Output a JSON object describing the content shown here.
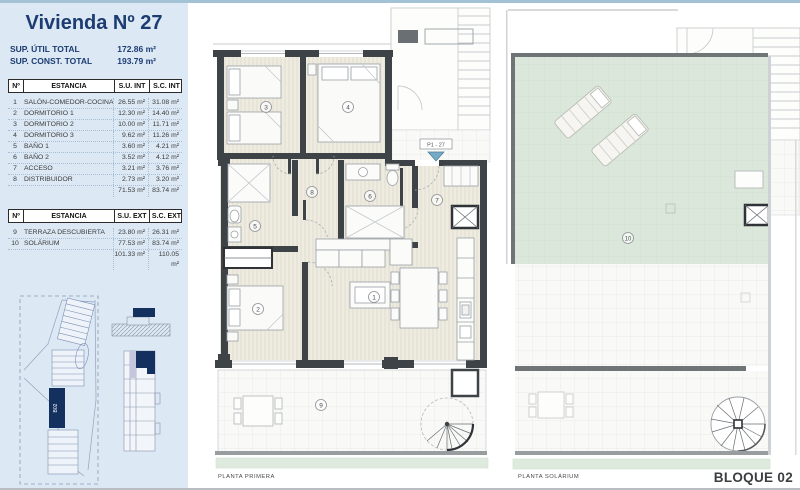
{
  "header": {
    "title": "Vivienda Nº 27"
  },
  "summary": {
    "rows": [
      {
        "label": "SUP. ÚTIL TOTAL",
        "value": "172.86 m²"
      },
      {
        "label": "SUP. CONST. TOTAL",
        "value": "193.79 m²"
      }
    ]
  },
  "interior_table": {
    "headers": {
      "num": "Nº",
      "name": "ESTANCIA",
      "su": "S.U. INT",
      "sc": "S.C. INT"
    },
    "rows": [
      {
        "num": "1",
        "name": "SALÓN-COMEDOR-COCINA",
        "su": "26.55 m²",
        "sc": "31.08 m²"
      },
      {
        "num": "2",
        "name": "DORMITORIO 1",
        "su": "12.30 m²",
        "sc": "14.40 m²"
      },
      {
        "num": "3",
        "name": "DORMITORIO 2",
        "su": "10.00 m²",
        "sc": "11.71 m²"
      },
      {
        "num": "4",
        "name": "DORMITORIO 3",
        "su": "9.62 m²",
        "sc": "11.26 m²"
      },
      {
        "num": "5",
        "name": "BAÑO 1",
        "su": "3.60 m²",
        "sc": "4.21 m²"
      },
      {
        "num": "6",
        "name": "BAÑO 2",
        "su": "3.52 m²",
        "sc": "4.12 m²"
      },
      {
        "num": "7",
        "name": "ACCESO",
        "su": "3.21 m²",
        "sc": "3.76 m²"
      },
      {
        "num": "8",
        "name": "DISTRIBUIDOR",
        "su": "2.73 m²",
        "sc": "3.20 m²"
      }
    ],
    "total": {
      "su": "71.53 m²",
      "sc": "83.74 m²"
    }
  },
  "exterior_table": {
    "headers": {
      "num": "Nº",
      "name": "ESTANCIA",
      "su": "S.U. EXT",
      "sc": "S.C. EXT"
    },
    "rows": [
      {
        "num": "9",
        "name": "TERRAZA DESCUBIERTA",
        "su": "23.80 m²",
        "sc": "26.31 m²"
      },
      {
        "num": "10",
        "name": "SOLÁRIUM",
        "su": "77.53 m²",
        "sc": "83.74 m²"
      }
    ],
    "total": {
      "su": "101.33 m²",
      "sc": "110.05 m²"
    }
  },
  "site_plan": {
    "block_label": "B02"
  },
  "plans": {
    "primera": {
      "caption": "PLANTA PRIMERA",
      "entrance_label": "P1 - 27",
      "rooms": [
        "1",
        "2",
        "3",
        "4",
        "5",
        "6",
        "7",
        "8",
        "9"
      ]
    },
    "solarium": {
      "caption": "PLANTA SOLÁRIUM",
      "rooms": [
        "10"
      ]
    }
  },
  "footer": {
    "block_label": "BLOQUE 02"
  },
  "colors": {
    "sidebar_bg": "#dce8f4",
    "navy": "#1c3c72",
    "wall": "#3e4347",
    "floor_beige": "#eeebe1",
    "solarium_green": "#dbe7da",
    "marker_blue": "#74aac6",
    "lavender": "#c6c4de"
  }
}
